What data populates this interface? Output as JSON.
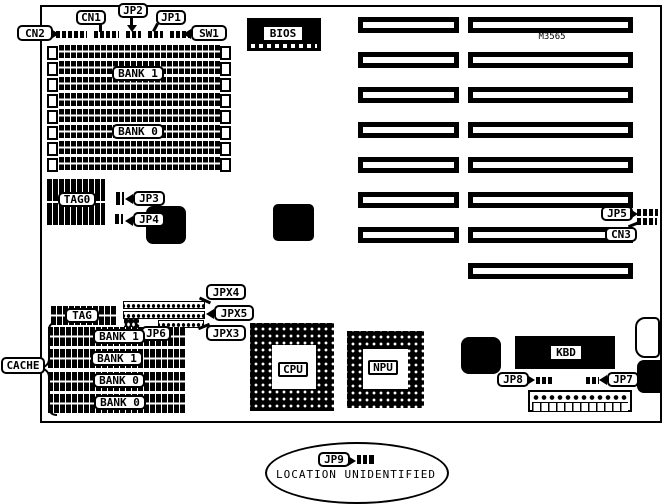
{
  "board": {
    "model_label": "M3565",
    "top_connectors": {
      "cn2": "CN2",
      "cn1": "CN1",
      "jp2": "JP2",
      "jp1": "JP1",
      "sw1": "SW1"
    },
    "memory": {
      "bank1": "BANK 1",
      "bank0": "BANK 0"
    },
    "bios_label": "BIOS",
    "tag0_label": "TAG0",
    "jumpers": {
      "jp3": "JP3",
      "jp4": "JP4",
      "jp5": "JP5",
      "jp6": "JP6",
      "jp7": "JP7",
      "jp8": "JP8",
      "cn3": "CN3",
      "jpx3": "JPX3",
      "jpx4": "JPX4",
      "jpx5": "JPX5"
    },
    "cache": {
      "group": "CACHE",
      "tag": "TAG",
      "rows": [
        "BANK 1",
        "BANK 1",
        "BANK 0",
        "BANK 0"
      ]
    },
    "cpu_label": "CPU",
    "npu_label": "NPU",
    "kbd_label": "KBD",
    "note": {
      "jumper": "JP9",
      "text": "LOCATION UNIDENTIFIED"
    }
  }
}
